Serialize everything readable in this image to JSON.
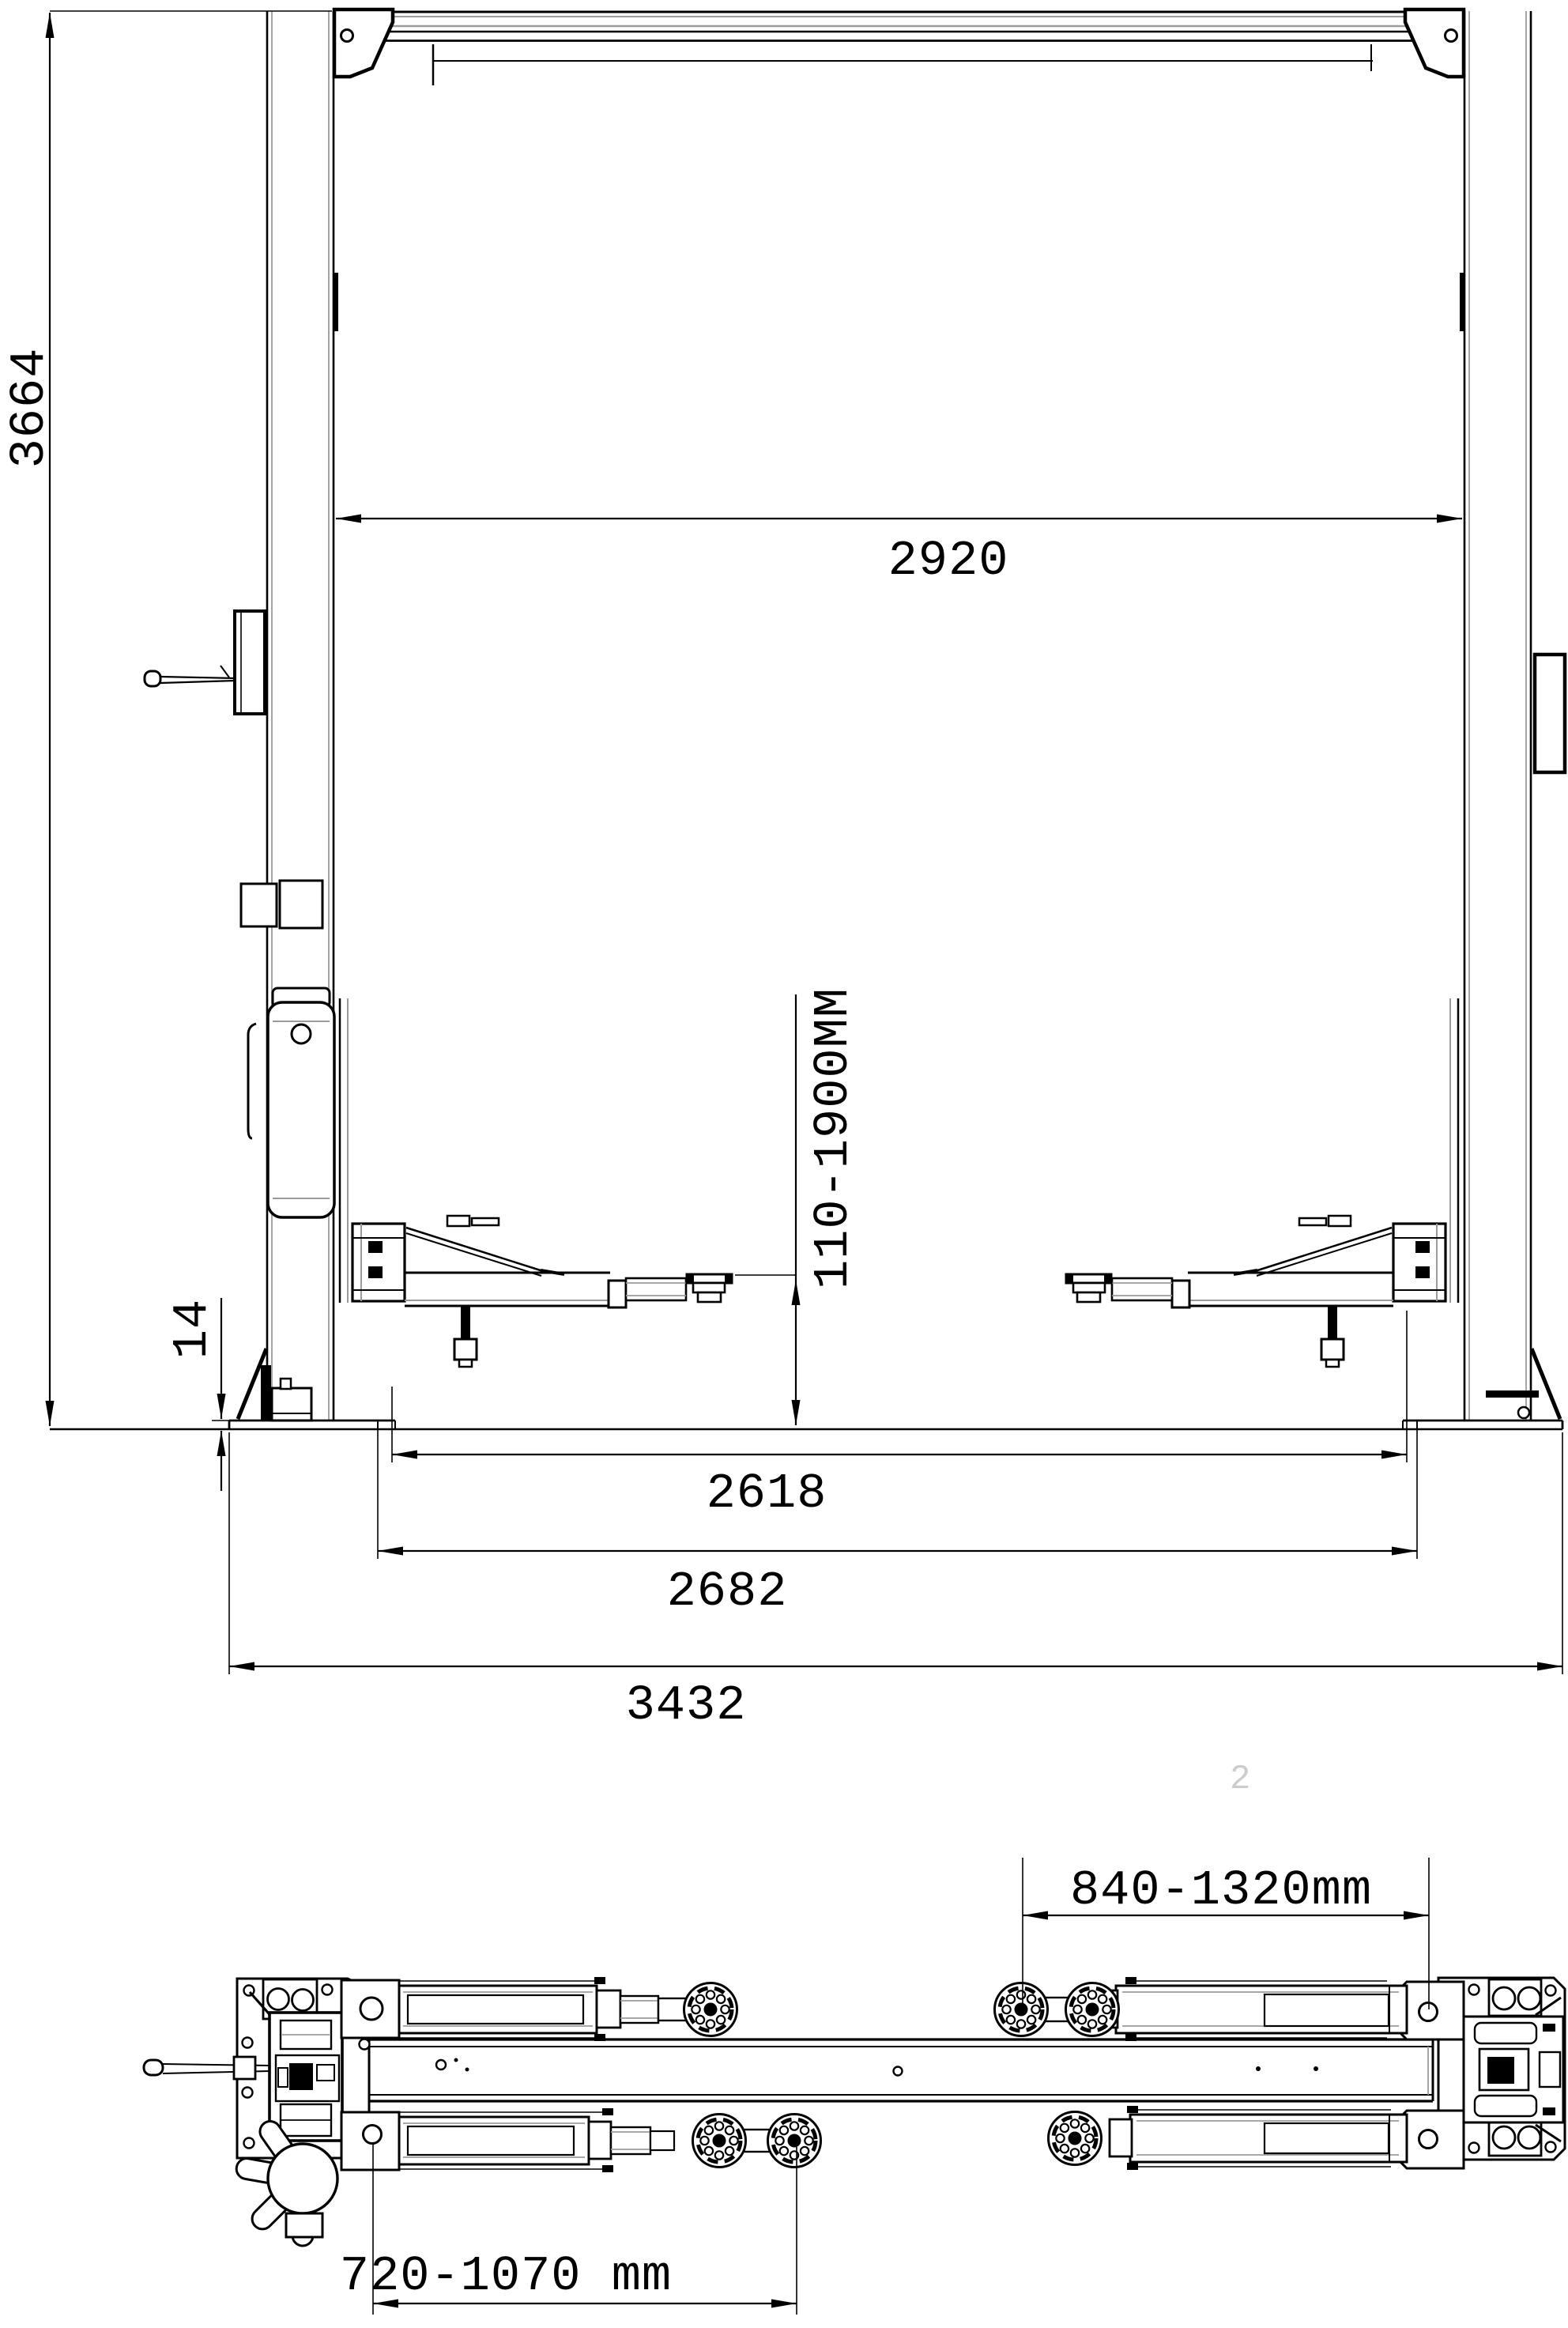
{
  "drawing": {
    "colors": {
      "line": "#000000",
      "secondary_line": "#9b9b9b",
      "watermark": "#cccccc",
      "background": "#ffffff"
    },
    "front_view": {
      "dim_total_height": "3664",
      "dim_post_clearance": "2920",
      "dim_lift_height_range": "110-1900MM",
      "dim_baseplate_thickness": "14",
      "dim_inner_width": "2618",
      "dim_drive_through_width": "2682",
      "dim_overall_base_width": "3432"
    },
    "plan_view": {
      "dim_rear_arm_span": "840-1320mm",
      "dim_front_arm_span": "720-1070 mm"
    },
    "watermark": {
      "text": "2",
      "color": "#cccccc"
    }
  }
}
